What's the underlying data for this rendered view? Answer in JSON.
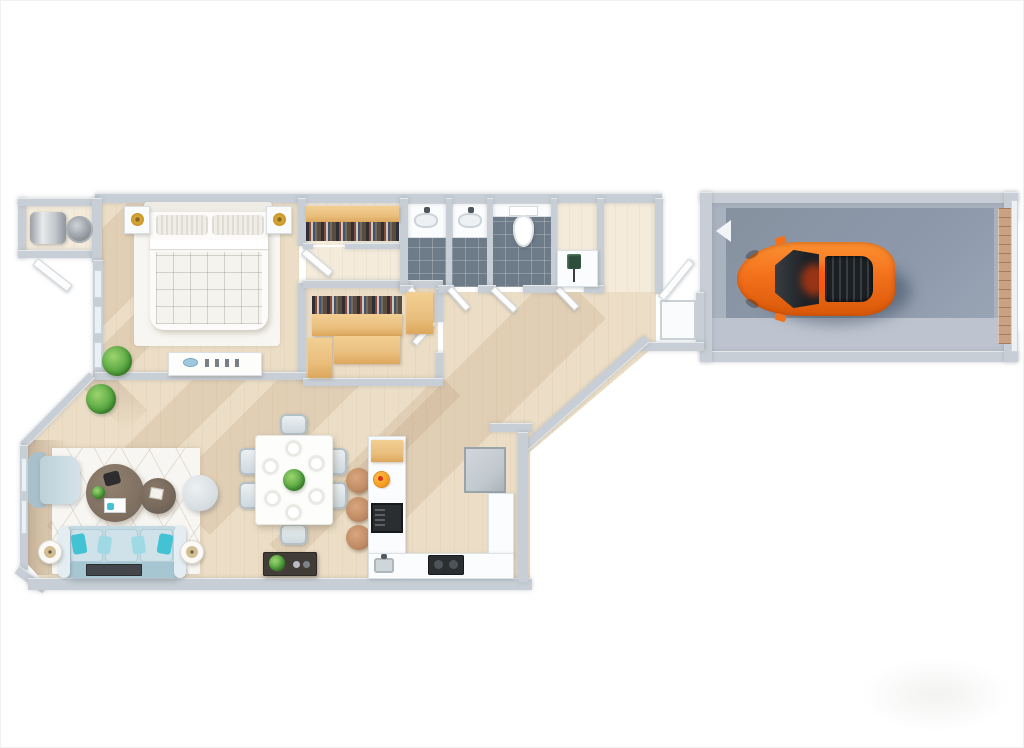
{
  "meta": {
    "description": "3D rendered top-down floor plan of a one-bedroom apartment with attached single-car garage; no text labels rendered",
    "view": "top-down isometric render on white background",
    "watermark": "faint light-gray logo blob in bottom-right corner"
  },
  "palette": {
    "wall": "#c7ced5",
    "floorWood": "#ecdec6",
    "floorWoodLight": "#f4ebdb",
    "tile": "#6e7c89",
    "closetWood": "#eabf7e",
    "closetDark": "#5c4c40",
    "garageFloor": "#a9b2bf",
    "garagePad": "#8d99ab",
    "garageApron": "#bdc4cf",
    "garageDoor": "#c9a183",
    "carOrange": "#f4711c",
    "carCabin": "#24282c",
    "sofaBlue": "#c3dae3",
    "pillowTeal": "#43c2d4",
    "pillowLight": "#9fd9e4",
    "plantGreen": "#5aa843",
    "plantDark": "#3f7d2e",
    "tableBrown": "#7d6e60",
    "stoolBrown": "#bf8a64",
    "rug": "#f8f6f2",
    "counterWhite": "#fbfcfd",
    "fridgeGray": "#c2c9cf",
    "darkAppliance": "#2a2e31",
    "lampGold": "#d9a93f"
  },
  "rooms": [
    {
      "id": "laundry-closet",
      "name": "Laundry / utility closet",
      "items": [
        "water-heater",
        "washer"
      ]
    },
    {
      "id": "bedroom",
      "name": "Bedroom",
      "items": [
        "double-bed",
        "2 pillows",
        "2 nightstands",
        "2 gold lamps",
        "area-rug",
        "dresser",
        "potted-plant"
      ]
    },
    {
      "id": "bedroom-closet",
      "name": "Reach-in closet",
      "items": [
        "wood shelf",
        "hanging clothes"
      ]
    },
    {
      "id": "walk-in-closet",
      "name": "Walk-in closet",
      "items": [
        "4 wood shelving units",
        "hanging clothes"
      ]
    },
    {
      "id": "bathroom-1",
      "name": "Vanity room 1",
      "items": [
        "vanity sink",
        "dark tile floor",
        "door"
      ]
    },
    {
      "id": "bathroom-2",
      "name": "Vanity room 2",
      "items": [
        "vanity sink",
        "dark tile floor",
        "door"
      ]
    },
    {
      "id": "toilet-room",
      "name": "Toilet room",
      "items": [
        "toilet",
        "dark tile floor",
        "door"
      ]
    },
    {
      "id": "powder-room",
      "name": "Powder room",
      "items": [
        "counter",
        "plant decor"
      ]
    },
    {
      "id": "foyer",
      "name": "Foyer to garage",
      "items": [
        "entry closet",
        "open door"
      ]
    },
    {
      "id": "living-room",
      "name": "Living room",
      "items": [
        "sofa",
        "4 throw pillows",
        "armchair",
        "round pouf",
        "2 round coffee tables",
        "2 side tables with lamps",
        "patterned rug",
        "tv console",
        "2 potted plants",
        "windows"
      ]
    },
    {
      "id": "dining-area",
      "name": "Dining area",
      "items": [
        "dining table",
        "6 chairs",
        "6 place settings",
        "green centerpiece",
        "dark sideboard with plant"
      ]
    },
    {
      "id": "kitchen",
      "name": "Kitchen",
      "items": [
        "island with cutting board",
        "fruit plate",
        "built-in oven",
        "3 bar stools",
        "refrigerator",
        "sink",
        "cooktop",
        "L-shaped counter"
      ]
    },
    {
      "id": "garage",
      "name": "Garage",
      "items": [
        "orange sports car facing left",
        "tan roll-up garage door",
        "white direction arrow",
        "concrete floor"
      ]
    }
  ],
  "counts": {
    "dining_chairs": 6,
    "place_settings": 6,
    "bar_stools": 3,
    "sofa_pillows": 4,
    "coffee_tables": 2,
    "side_tables": 2,
    "nightstands": 2,
    "plants_visible": 5,
    "toilets": 1,
    "vanity_sinks": 2,
    "cars": 1
  },
  "car": {
    "type": "sports-car-top-view",
    "color": "#f4711c",
    "cabin": "#24282c",
    "facing": "left",
    "location": "garage"
  }
}
